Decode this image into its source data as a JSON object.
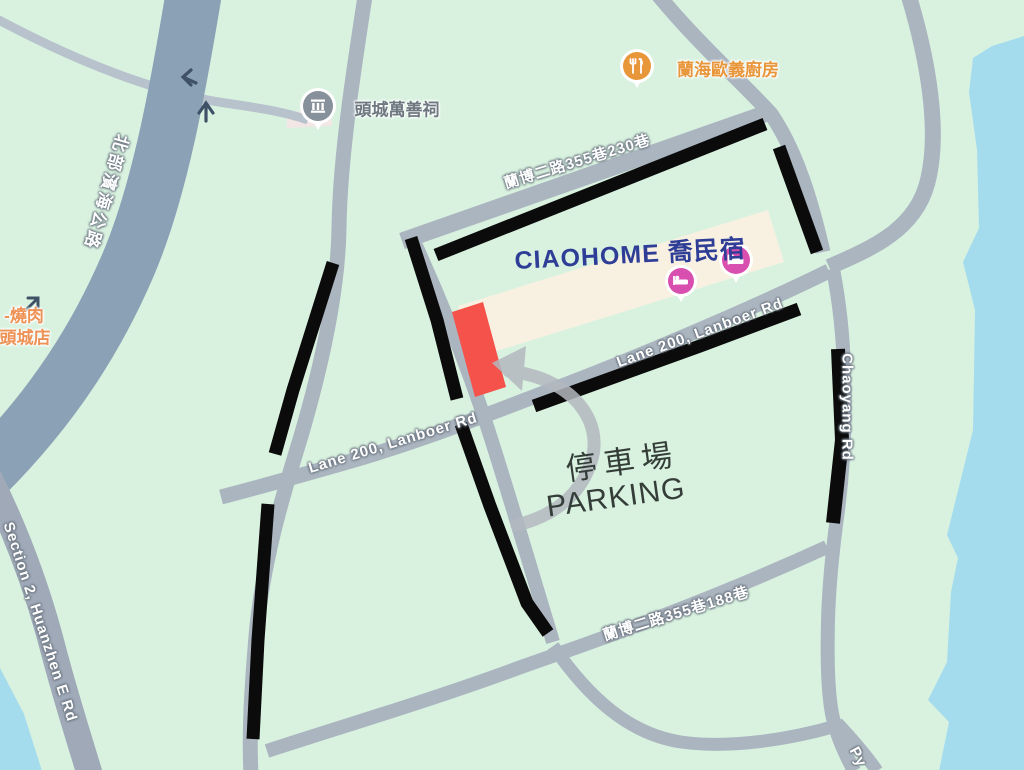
{
  "map": {
    "pois": {
      "temple": "頭城萬善祠",
      "italian_kitchen": "蘭海歐義廚房",
      "yakiniku_line1": "-燒肉",
      "yakiniku_line2": "頭城店",
      "guesthouse": "CIAOHOME 喬民宿"
    },
    "road_labels": {
      "coastal_highway": "北部濱海公路",
      "lane_230": "蘭博二路355巷230巷",
      "lane200_upper": "Lane 200, Lanboer Rd",
      "lane200_lower": "Lane 200, Lanboer Rd",
      "chaoyang": "Chaoyang Rd",
      "lane_188": "蘭博二路355巷188巷",
      "huanzhen": "Section 2, Huanzhen E Rd",
      "py_partial": "Py"
    },
    "annotations": {
      "parking_zh": "停車場",
      "parking_en": "PARKING"
    },
    "colors": {
      "land": "#d9f2e0",
      "water": "#a4dcee",
      "road": "#abb5c0",
      "highway": "#8ba1b6",
      "building": "#f8f1e1",
      "route_black": "#0b0b0b",
      "parking_marker": "#f4524a",
      "arrow_gray": "#b3b8be",
      "guesthouse_blue": "#2e3d96",
      "poi_orange": "#e8963a",
      "lodging_pink": "#d94fb0",
      "temple_gray": "#87919b",
      "annotation_dark": "#343d38"
    }
  }
}
